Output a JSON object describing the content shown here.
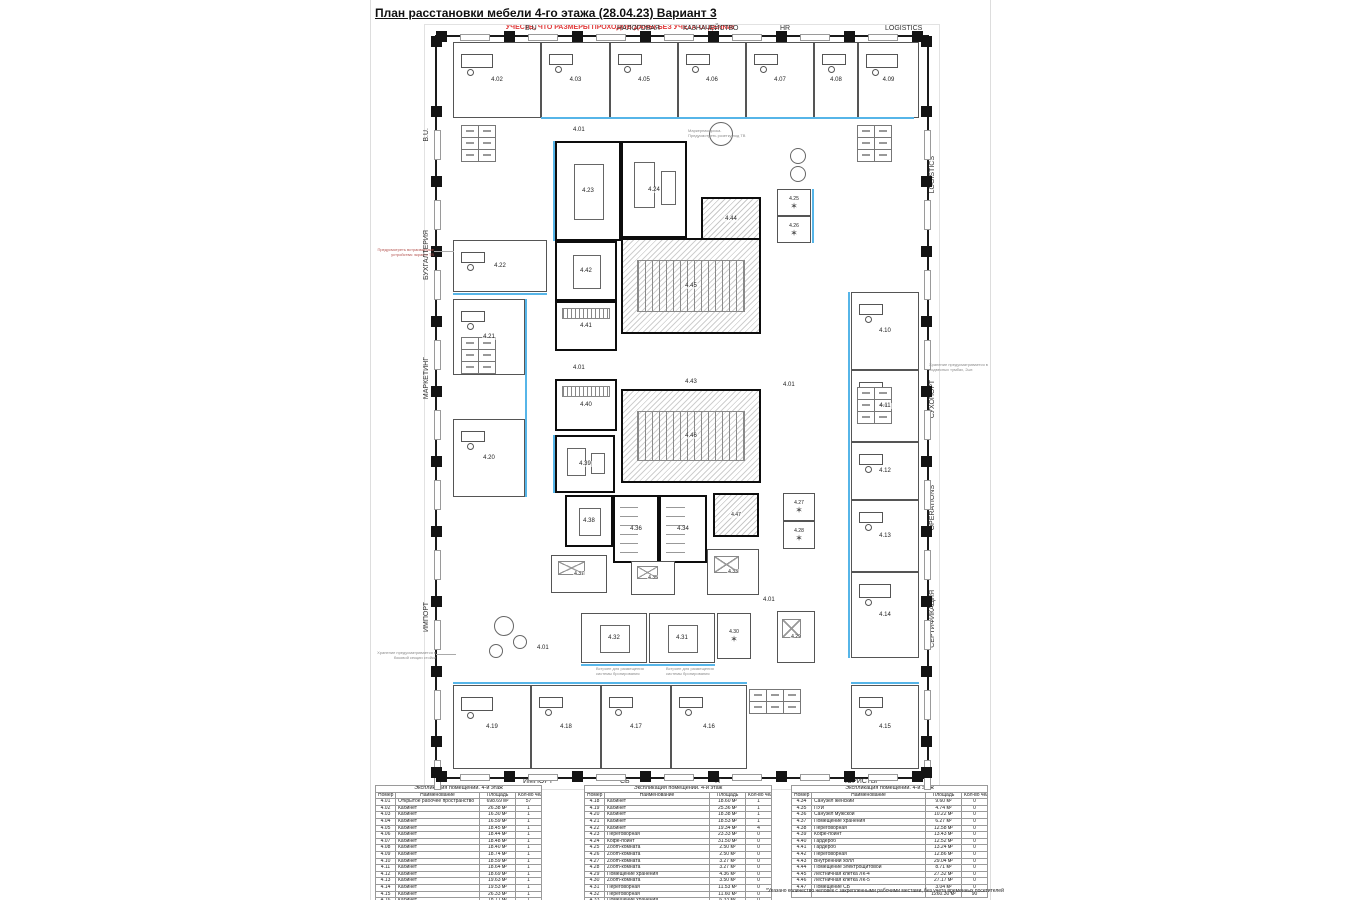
{
  "title": "План расстановки мебели 4-го этажа (28.04.23) Вариант 3",
  "warning": "УЧЕСТЬ, ЧТО РАЗМЕРЫ ПРОХОДОВ ДАНЫ БЕЗ УЧЕТА ОТДЕЛКИ!",
  "colors": {
    "accent_blue": "#56b5e8",
    "warning_red": "#e03a3a",
    "wall": "#1a1a1a",
    "hatch_gray": "#c9c9c9"
  },
  "departments": {
    "top": [
      {
        "label": "B.U",
        "x": 90
      },
      {
        "label": "НАЛОГОВАЯ",
        "x": 182
      },
      {
        "label": "КАЗНАЧЕЙСТВО",
        "x": 248
      },
      {
        "label": "HR",
        "x": 345
      },
      {
        "label": "LOGISTICS",
        "x": 450
      }
    ],
    "bottom": [
      {
        "label": "ИМПОРТ",
        "x": 88
      },
      {
        "label": "СБ",
        "x": 185
      },
      {
        "label": "IT",
        "x": 280
      },
      {
        "label": "ЮРИСТЫ",
        "x": 410
      }
    ],
    "left": [
      {
        "label": "B.U.",
        "y": 93
      },
      {
        "label": "БУХГАЛТЕРИЯ",
        "y": 195
      },
      {
        "label": "МАРКЕТИНГ",
        "y": 322
      },
      {
        "label": "ИМПОРТ",
        "y": 567
      }
    ],
    "right": [
      {
        "label": "LOGISTICS",
        "y": 121
      },
      {
        "label": "СУХОПОРТ",
        "y": 345
      },
      {
        "label": "OPERATIONS",
        "y": 450
      },
      {
        "label": "СЕРТИФИКАЦИЯ",
        "y": 555
      }
    ]
  },
  "plan": {
    "open_space_label": "4.01",
    "open_labels": [
      {
        "x": 136,
        "y": 90
      },
      {
        "x": 136,
        "y": 328
      },
      {
        "x": 346,
        "y": 345
      },
      {
        "x": 326,
        "y": 560
      },
      {
        "x": 100,
        "y": 608
      }
    ],
    "rooms": [
      {
        "id": "4.02",
        "x": 16,
        "y": 5,
        "w": 88,
        "h": 76,
        "type": "exec"
      },
      {
        "id": "4.03",
        "x": 104,
        "y": 5,
        "w": 69,
        "h": 76,
        "type": "office"
      },
      {
        "id": "4.05",
        "x": 173,
        "y": 5,
        "w": 68,
        "h": 76,
        "type": "office"
      },
      {
        "id": "4.06",
        "x": 241,
        "y": 5,
        "w": 68,
        "h": 76,
        "type": "office"
      },
      {
        "id": "4.07",
        "x": 309,
        "y": 5,
        "w": 68,
        "h": 76,
        "type": "office"
      },
      {
        "id": "4.08",
        "x": 377,
        "y": 5,
        "w": 44,
        "h": 76,
        "type": "office"
      },
      {
        "id": "4.09",
        "x": 421,
        "y": 5,
        "w": 61,
        "h": 76,
        "type": "exec"
      },
      {
        "id": "4.10",
        "x": 414,
        "y": 255,
        "w": 68,
        "h": 78,
        "type": "office"
      },
      {
        "id": "4.11",
        "x": 414,
        "y": 333,
        "w": 68,
        "h": 72,
        "type": "office"
      },
      {
        "id": "4.12",
        "x": 414,
        "y": 405,
        "w": 68,
        "h": 58,
        "type": "office"
      },
      {
        "id": "4.13",
        "x": 414,
        "y": 463,
        "w": 68,
        "h": 72,
        "type": "office"
      },
      {
        "id": "4.14",
        "x": 414,
        "y": 535,
        "w": 68,
        "h": 86,
        "type": "exec"
      },
      {
        "id": "4.15",
        "x": 414,
        "y": 648,
        "w": 68,
        "h": 84,
        "type": "office"
      },
      {
        "id": "4.16",
        "x": 234,
        "y": 648,
        "w": 76,
        "h": 84,
        "type": "office"
      },
      {
        "id": "4.17",
        "x": 164,
        "y": 648,
        "w": 70,
        "h": 84,
        "type": "office"
      },
      {
        "id": "4.18",
        "x": 94,
        "y": 648,
        "w": 70,
        "h": 84,
        "type": "office"
      },
      {
        "id": "4.19",
        "x": 16,
        "y": 648,
        "w": 78,
        "h": 84,
        "type": "exec"
      },
      {
        "id": "4.20",
        "x": 16,
        "y": 382,
        "w": 72,
        "h": 78,
        "type": "office"
      },
      {
        "id": "4.21",
        "x": 16,
        "y": 262,
        "w": 72,
        "h": 76,
        "type": "office"
      },
      {
        "id": "4.22",
        "x": 16,
        "y": 203,
        "w": 94,
        "h": 52,
        "type": "office"
      },
      {
        "id": "4.23",
        "x": 118,
        "y": 104,
        "w": 66,
        "h": 100,
        "type": "meeting core"
      },
      {
        "id": "4.24",
        "x": 184,
        "y": 104,
        "w": 66,
        "h": 97,
        "type": "coffee core"
      },
      {
        "id": "4.44",
        "x": 264,
        "y": 160,
        "w": 60,
        "h": 44,
        "type": "hatch core"
      },
      {
        "id": "4.25",
        "x": 340,
        "y": 152,
        "w": 34,
        "h": 27,
        "type": "zoom small"
      },
      {
        "id": "4.26",
        "x": 340,
        "y": 179,
        "w": 34,
        "h": 27,
        "type": "zoom small"
      },
      {
        "id": "4.42",
        "x": 118,
        "y": 204,
        "w": 62,
        "h": 60,
        "type": "meeting core"
      },
      {
        "id": "4.45",
        "x": 184,
        "y": 201,
        "w": 140,
        "h": 96,
        "type": "stairs core"
      },
      {
        "id": "4.41",
        "x": 118,
        "y": 264,
        "w": 62,
        "h": 50,
        "type": "ward core"
      },
      {
        "id": "4.43",
        "x": 186,
        "y": 300,
        "w": 136,
        "h": 90,
        "type": "labelonly"
      },
      {
        "id": "4.40",
        "x": 118,
        "y": 342,
        "w": 62,
        "h": 52,
        "type": "ward core"
      },
      {
        "id": "4.46",
        "x": 184,
        "y": 352,
        "w": 140,
        "h": 94,
        "type": "stairs core"
      },
      {
        "id": "4.39",
        "x": 118,
        "y": 398,
        "w": 60,
        "h": 58,
        "type": "coffee core"
      },
      {
        "id": "4.38",
        "x": 128,
        "y": 458,
        "w": 48,
        "h": 52,
        "type": "meeting core"
      },
      {
        "id": "4.36",
        "x": 176,
        "y": 458,
        "w": 46,
        "h": 68,
        "type": "wc core"
      },
      {
        "id": "4.34",
        "x": 222,
        "y": 458,
        "w": 48,
        "h": 68,
        "type": "wc core"
      },
      {
        "id": "4.47",
        "x": 276,
        "y": 456,
        "w": 46,
        "h": 44,
        "type": "hatch core small"
      },
      {
        "id": "4.37",
        "x": 114,
        "y": 518,
        "w": 56,
        "h": 38,
        "type": "storage small"
      },
      {
        "id": "4.35",
        "x": 194,
        "y": 524,
        "w": 44,
        "h": 34,
        "type": "storage small"
      },
      {
        "id": "4.33",
        "x": 270,
        "y": 512,
        "w": 52,
        "h": 46,
        "type": "storage small"
      },
      {
        "id": "4.32",
        "x": 144,
        "y": 576,
        "w": 66,
        "h": 50,
        "type": "meeting"
      },
      {
        "id": "4.31",
        "x": 212,
        "y": 576,
        "w": 66,
        "h": 50,
        "type": "meeting"
      },
      {
        "id": "4.30",
        "x": 280,
        "y": 576,
        "w": 34,
        "h": 46,
        "type": "zoom small"
      },
      {
        "id": "4.29",
        "x": 340,
        "y": 574,
        "w": 38,
        "h": 52,
        "type": "storage small"
      },
      {
        "id": "4.27",
        "x": 346,
        "y": 456,
        "w": 32,
        "h": 28,
        "type": "zoom small"
      },
      {
        "id": "4.28",
        "x": 346,
        "y": 484,
        "w": 32,
        "h": 28,
        "type": "zoom small"
      }
    ]
  },
  "annotations": [
    {
      "name": "tv-note",
      "text": "Предусмотреть встраиваемые устройства: экран и ТВ",
      "x": 372,
      "y": 247,
      "w": 62,
      "align": "right",
      "red": true,
      "leader": true
    },
    {
      "name": "storage-note-left",
      "text": "Хранение предусматривается в боковой секции стойки",
      "x": 376,
      "y": 650,
      "w": 60,
      "align": "right",
      "red": false,
      "leader": true
    },
    {
      "name": "storage-note-right",
      "text": "Хранение предусматривается в подвесных тумбах, 2шт.",
      "x": 929,
      "y": 362,
      "w": 62,
      "align": "left",
      "red": false,
      "leader": false
    },
    {
      "name": "marker-board-note",
      "text": "Маркерная доска. Предусмотреть розетку под ТВ",
      "x": 688,
      "y": 128,
      "w": 58,
      "align": "left",
      "red": false,
      "leader": false
    },
    {
      "name": "booking-note-1",
      "text": "Встроен для размещения системы бронирования",
      "x": 596,
      "y": 666,
      "w": 56,
      "align": "left",
      "red": false,
      "leader": false
    },
    {
      "name": "booking-note-2",
      "text": "Встроен для размещения системы бронирования",
      "x": 666,
      "y": 666,
      "w": 56,
      "align": "left",
      "red": false,
      "leader": false
    }
  ],
  "tables": [
    {
      "title": "Экспликация помещений. 4-й этаж",
      "headers": [
        "Номер",
        "Наименование",
        "Площадь",
        "Кол-во чел.*"
      ],
      "rows": [
        [
          "4.01",
          "Открытое рабочее пространство",
          "698.69 м²",
          "57"
        ],
        [
          "4.02",
          "Кабинет",
          "26.38 м²",
          "1"
        ],
        [
          "4.03",
          "Кабинет",
          "16.30 м²",
          "1"
        ],
        [
          "4.04",
          "Кабинет",
          "16.59 м²",
          "1"
        ],
        [
          "4.05",
          "Кабинет",
          "18.45 м²",
          "1"
        ],
        [
          "4.06",
          "Кабинет",
          "18.44 м²",
          "1"
        ],
        [
          "4.07",
          "Кабинет",
          "18.48 м²",
          "1"
        ],
        [
          "4.08",
          "Кабинет",
          "18.40 м²",
          "1"
        ],
        [
          "4.09",
          "Кабинет",
          "18.74 м²",
          "1"
        ],
        [
          "4.10",
          "Кабинет",
          "18.59 м²",
          "1"
        ],
        [
          "4.11",
          "Кабинет",
          "18.64 м²",
          "1"
        ],
        [
          "4.12",
          "Кабинет",
          "18.69 м²",
          "1"
        ],
        [
          "4.13",
          "Кабинет",
          "19.63 м²",
          "1"
        ],
        [
          "4.14",
          "Кабинет",
          "19.53 м²",
          "1"
        ],
        [
          "4.15",
          "Кабинет",
          "26.33 м²",
          "1"
        ],
        [
          "4.16",
          "Кабинет",
          "18.71 м²",
          "1"
        ],
        [
          "4.17",
          "Кабинет",
          "18.74 м²",
          "1"
        ]
      ]
    },
    {
      "title": "Экспликация помещений. 4-й этаж",
      "headers": [
        "Номер",
        "Наименование",
        "Площадь",
        "Кол-во чел.*"
      ],
      "rows": [
        [
          "4.18",
          "Кабинет",
          "18.60 м²",
          "1"
        ],
        [
          "4.19",
          "Кабинет",
          "25.36 м²",
          "1"
        ],
        [
          "4.20",
          "Кабинет",
          "18.38 м²",
          "1"
        ],
        [
          "4.21",
          "Кабинет",
          "18.53 м²",
          "1"
        ],
        [
          "4.22",
          "Кабинет",
          "19.34 м²",
          "4"
        ],
        [
          "4.23",
          "Переговорная",
          "23.33 м²",
          "0"
        ],
        [
          "4.24",
          "Кофе-поинт",
          "31.50 м²",
          "0"
        ],
        [
          "4.25",
          "Zoom-комната",
          "2.50 м²",
          "0"
        ],
        [
          "4.26",
          "Zoom-комната",
          "2.50 м²",
          "0"
        ],
        [
          "4.27",
          "Zoom-комната",
          "3.27 м²",
          "0"
        ],
        [
          "4.28",
          "Zoom-комната",
          "3.27 м²",
          "0"
        ],
        [
          "4.29",
          "Помещение хранения",
          "4.36 м²",
          "0"
        ],
        [
          "4.30",
          "Zoom-комната",
          "3.50 м²",
          "0"
        ],
        [
          "4.31",
          "Переговорная",
          "11.53 м²",
          "0"
        ],
        [
          "4.32",
          "Переговорная",
          "11.60 м²",
          "0"
        ],
        [
          "4.33",
          "Помещение хранения",
          "6.33 м²",
          "0"
        ]
      ]
    },
    {
      "title": "Экспликация помещений. 4-й этаж",
      "headers": [
        "Номер",
        "Наименование",
        "Площадь",
        "Кол-во чел.*"
      ],
      "rows": [
        [
          "4.34",
          "Санузел женский",
          "9.60 м²",
          "0"
        ],
        [
          "4.35",
          "ПУИ",
          "4.74 м²",
          "0"
        ],
        [
          "4.36",
          "Санузел мужской",
          "10.22 м²",
          "0"
        ],
        [
          "4.37",
          "Помещение хранения",
          "6.27 м²",
          "0"
        ],
        [
          "4.38",
          "Переговорная",
          "12.58 м²",
          "0"
        ],
        [
          "4.39",
          "Кофе-поинт",
          "13.43 м²",
          "0"
        ],
        [
          "4.40",
          "Гардероб",
          "12.52 м²",
          "0"
        ],
        [
          "4.41",
          "Гардероб",
          "13.24 м²",
          "0"
        ],
        [
          "4.42",
          "Переговорная",
          "12.86 м²",
          "0"
        ],
        [
          "4.43",
          "Внутренний холл",
          "29.04 м²",
          "0"
        ],
        [
          "4.44",
          "Помещение электрощитовой",
          "8.71 м²",
          "0"
        ],
        [
          "4.45",
          "Лестничная клетка ЛК-4",
          "27.32 м²",
          "0"
        ],
        [
          "4.46",
          "Лестничная клетка ЛК-5",
          "27.17 м²",
          "0"
        ],
        [
          "4.47",
          "Помещение СБ",
          "3.04 м²",
          "0"
        ]
      ],
      "total": [
        "",
        "",
        "1260.30 м²",
        "90"
      ],
      "footnote": "*Указано количество человек с закрепленными рабочими местами, без учета временных посетителей"
    }
  ]
}
